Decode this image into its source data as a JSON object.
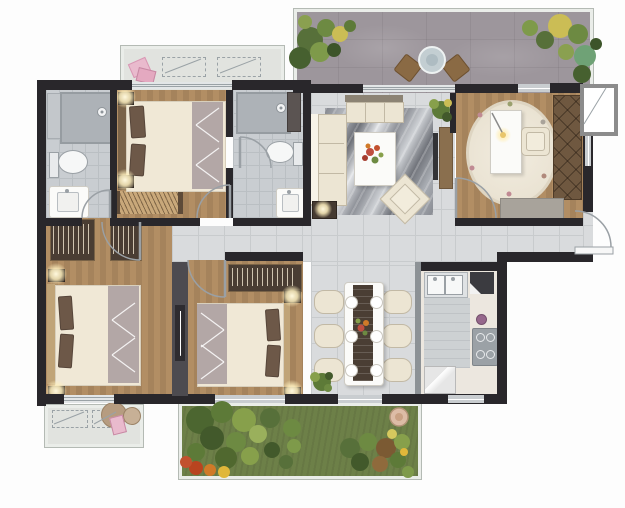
{
  "meta": {
    "description": "Top-down rendered residential floor plan of a three-bedroom apartment with terrace and garden; no text labels are rendered in the image",
    "canvas": {
      "width": 625,
      "height": 508
    }
  },
  "palette": {
    "wall": "#29272b",
    "wall_gray": "#4d4b50",
    "window_fill": "#c9cdd0",
    "slider_fill": "#e3e6e7",
    "slider_line": "#9aa2a6",
    "tile": "#d9dbdd",
    "tile_line": "#c8cbcd",
    "bath": "#c9cdd1",
    "bath_line": "#babfc3",
    "wood": "#b28e64",
    "wood_line": "#a5835c",
    "stone": "#9d969c",
    "balcony": "#e1e3df",
    "frame_band": "#eaede9",
    "frame_line": "#b4bab4",
    "garden": "#6d8048",
    "cream": "#ece5d3",
    "cream_line": "#c2b9a5",
    "white_furn": "#fbfbf9",
    "headboard": "#7a6349",
    "pillow": "#6d5848",
    "duvet": "#f0e8d6",
    "throw": "#b3a7a6",
    "wardrobe": "#4a3d33",
    "wardrobe_trim": "#7a6347",
    "study_wood": "#6f5840",
    "runner": "#4a3e34",
    "pink": "#e9bacd",
    "glow": "#fff8dd",
    "counter": "#ece7df",
    "steel": "#3b3b40",
    "hob": "#9ba1a6",
    "plant_dark": "#42592b",
    "plant_mid": "#5d7a38",
    "plant_light": "#87a04b",
    "flower_red": "#bf4b2a",
    "flower_yellow": "#d6c95e",
    "stool": "#b69c80",
    "arc": "#9aa0a5"
  },
  "rooms": [
    {
      "name": "terrace",
      "features": [
        "stone paving",
        "shrub planting beds",
        "round patio table",
        "two patio chairs"
      ]
    },
    {
      "name": "living-room",
      "features": [
        "three-seat sofa",
        "bench sofa",
        "marble area rug",
        "coffee table with flowers",
        "rotated armchair",
        "tv console",
        "lamp table",
        "potted plant"
      ]
    },
    {
      "name": "study",
      "features": [
        "oval floral rug",
        "white desk with lamp",
        "desk chair",
        "x-front wardrobe",
        "low cabinet"
      ]
    },
    {
      "name": "master-bedroom",
      "features": [
        "double bed",
        "two nightstand lamps",
        "hatched storage bench",
        "balcony sliding door"
      ]
    },
    {
      "name": "ensuite-bathroom",
      "features": [
        "shower",
        "toilet",
        "vanity sink",
        "dark shelf"
      ]
    },
    {
      "name": "hall-bathroom",
      "features": [
        "shower",
        "toilet",
        "vanity sink",
        "storage shelf"
      ]
    },
    {
      "name": "bedroom-2",
      "features": [
        "double bed",
        "two wardrobes with hangers",
        "two corner lamps",
        "balcony sliding door"
      ]
    },
    {
      "name": "bedroom-3",
      "features": [
        "double bed",
        "hanger wardrobe",
        "two corner lamps",
        "sliding partition door"
      ]
    },
    {
      "name": "dining-room",
      "features": [
        "table for six with dark runner",
        "six oval chairs",
        "six place settings",
        "potted plant"
      ]
    },
    {
      "name": "kitchen",
      "features": [
        "double sink",
        "dark stove unit",
        "four-burner hob",
        "refrigerator",
        "l-counters"
      ]
    },
    {
      "name": "balcony-top",
      "features": [
        "two dashed equipment platforms",
        "pink cushions"
      ]
    },
    {
      "name": "balcony-bottom",
      "features": [
        "two dashed equipment platforms",
        "round stools",
        "pink towel"
      ]
    },
    {
      "name": "garden",
      "features": [
        "lawn",
        "shrub clusters",
        "red and yellow flower beds",
        "small round table"
      ]
    },
    {
      "name": "entry",
      "features": [
        "outswing entry door on right wall"
      ]
    },
    {
      "name": "equipment-shaft",
      "features": [
        "white platform box with diagonal symbol"
      ]
    }
  ]
}
